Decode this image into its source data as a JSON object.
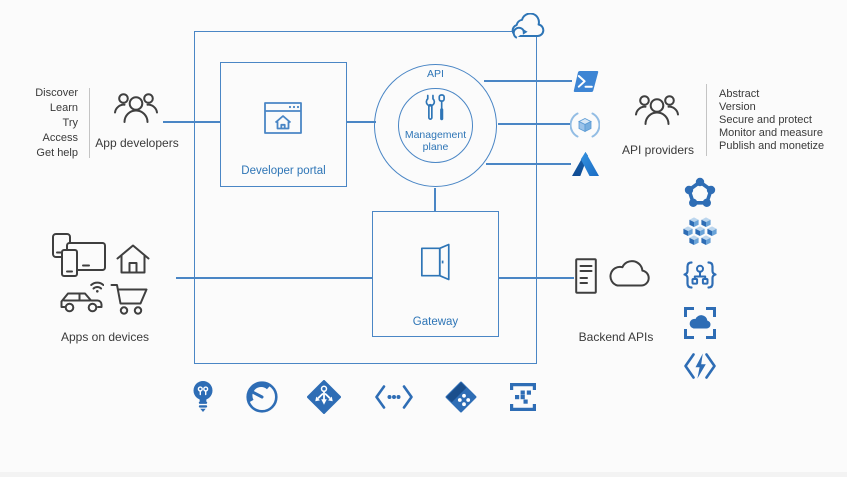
{
  "colors": {
    "outline_blue": "#4a86c5",
    "accent_blue": "#2e75b6",
    "icon_blue": "#2e6db5",
    "dark_text": "#3a3a3a",
    "background": "#fbfbfb"
  },
  "app_developers": {
    "label": "App developers",
    "capabilities": [
      "Discover",
      "Learn",
      "Try",
      "Access",
      "Get help"
    ]
  },
  "api_providers": {
    "label": "API providers",
    "capabilities": [
      "Abstract",
      "Version",
      "Secure and protect",
      "Monitor and measure",
      "Publish and monetize"
    ]
  },
  "apps_on_devices": {
    "label": "Apps on devices"
  },
  "backend_apis": {
    "label": "Backend APIs"
  },
  "developer_portal": {
    "label": "Developer portal"
  },
  "management_plane": {
    "api_label": "API",
    "label": "Management plane"
  },
  "gateway": {
    "label": "Gateway"
  },
  "icons": {
    "top": "cloud-sync-icon",
    "app_developers": "people-icon",
    "api_providers": "people-icon",
    "developer_portal": "browser-home-icon",
    "management_plane": "tools-icon",
    "gateway": "door-icon",
    "provider_tools": [
      "powershell-icon",
      "package-cube-icon",
      "azure-logo-icon"
    ],
    "devices": [
      "devices-icon",
      "home-icon",
      "car-icon",
      "shopping-cart-icon"
    ],
    "backend": [
      "server-icon",
      "cloud-icon"
    ],
    "compute_services": [
      "service-fabric-icon",
      "container-cluster-icon",
      "api-hierarchy-braces-icon",
      "cloud-frame-icon",
      "functions-icon"
    ],
    "capability_row": [
      "lightbulb-icon",
      "gauge-icon",
      "routing-diamond-icon",
      "code-ellipsis-icon",
      "tag-icon",
      "policy-list-icon"
    ]
  }
}
